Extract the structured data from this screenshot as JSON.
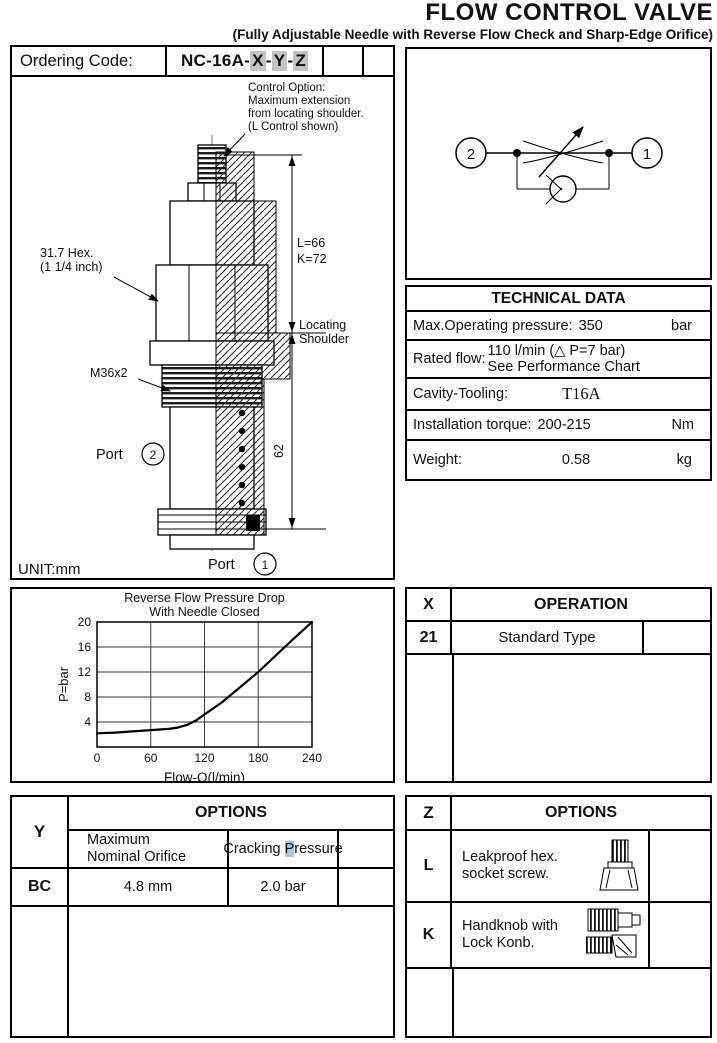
{
  "page": {
    "title": "FLOW CONTROL VALVE",
    "subtitle": "(Fully Adjustable Needle with Reverse Flow Check and Sharp-Edge Orifice)"
  },
  "ordering": {
    "label": "Ordering Code:",
    "prefix": "NC-16A-",
    "x": "X",
    "sep": "-",
    "y": "Y",
    "z": "Z"
  },
  "drawing": {
    "note1": "Control Option:",
    "note2": "Maximum extension",
    "note3": "from locating shoulder.",
    "note4": "(L Control shown)",
    "hex1": "31.7 Hex.",
    "hex2": "(1 1/4 inch)",
    "thread": "M36x2",
    "dim_l": "L=66",
    "dim_k": "K=72",
    "loc1": "Locating",
    "loc2": "Shoulder",
    "dim_height": "62",
    "port2_label": "Port",
    "port2_num": "2",
    "port1_label": "Port",
    "port1_num": "1",
    "unit": "UNIT:mm"
  },
  "symbol": {
    "port_left": "2",
    "port_right": "1"
  },
  "technical": {
    "header": "TECHNICAL DATA",
    "row1": {
      "label": "Max.Operating pressure:",
      "value": "350",
      "unit": "bar"
    },
    "row2": {
      "label": "Rated flow:",
      "line1": "110 l/min (△ P=7 bar)",
      "line2": "See Performance Chart"
    },
    "row3": {
      "label": "Cavity-Tooling:",
      "value": "T16A",
      "unit": ""
    },
    "row4": {
      "label": "Installation torque:",
      "value": "200-215",
      "unit": "Nm"
    },
    "row5": {
      "label": "Weight:",
      "value": "0.58",
      "unit": "kg"
    }
  },
  "operation": {
    "col": "X",
    "header": "OPERATION",
    "row": {
      "code": "21",
      "label": "Standard Type"
    }
  },
  "options_y": {
    "col": "Y",
    "header": "OPTIONS",
    "sub_orifice_line1": "Maximum",
    "sub_orifice_line2": "Nominal Orifice",
    "sub_cracking_pre": "Cracking",
    "sub_cracking_hl": "P",
    "sub_cracking_post": "ressure",
    "row": {
      "code": "BC",
      "orifice": "4.8 mm",
      "pressure": "2.0 bar"
    }
  },
  "options_z": {
    "col": "Z",
    "header": "OPTIONS",
    "rows": [
      {
        "code": "L",
        "line1": "Leakproof hex.",
        "line2": "socket screw.",
        "icon": "socket-screw-icon"
      },
      {
        "code": "K",
        "line1": "Handknob with",
        "line2": "Lock Konb.",
        "icon": "handknob-icon"
      }
    ]
  },
  "chart_data": {
    "type": "line",
    "title": "Reverse Flow Pressure Drop",
    "title2": "With Needle Closed",
    "xlabel": "Flow-Q(l/min)",
    "ylabel": "P=bar",
    "xlim": [
      0,
      240
    ],
    "ylim": [
      0,
      20
    ],
    "xticks": [
      0,
      60,
      120,
      180,
      240
    ],
    "yticks": [
      4,
      8,
      12,
      16,
      20
    ],
    "grid": true,
    "legend": "none",
    "series": [
      {
        "name": "Reverse flow pressure drop with needle closed",
        "x": [
          0,
          20,
          40,
          60,
          80,
          90,
          100,
          110,
          120,
          140,
          160,
          180,
          200,
          220,
          240
        ],
        "y": [
          2.2,
          2.3,
          2.5,
          2.7,
          2.9,
          3.1,
          3.5,
          4.2,
          5.2,
          7.2,
          9.6,
          12,
          14.7,
          17.4,
          20
        ]
      }
    ]
  },
  "colors": {
    "ink": "#111111",
    "border": "#000000",
    "code_highlight": "#c4c4c4",
    "cracking_highlight": "#a9c7e8"
  }
}
